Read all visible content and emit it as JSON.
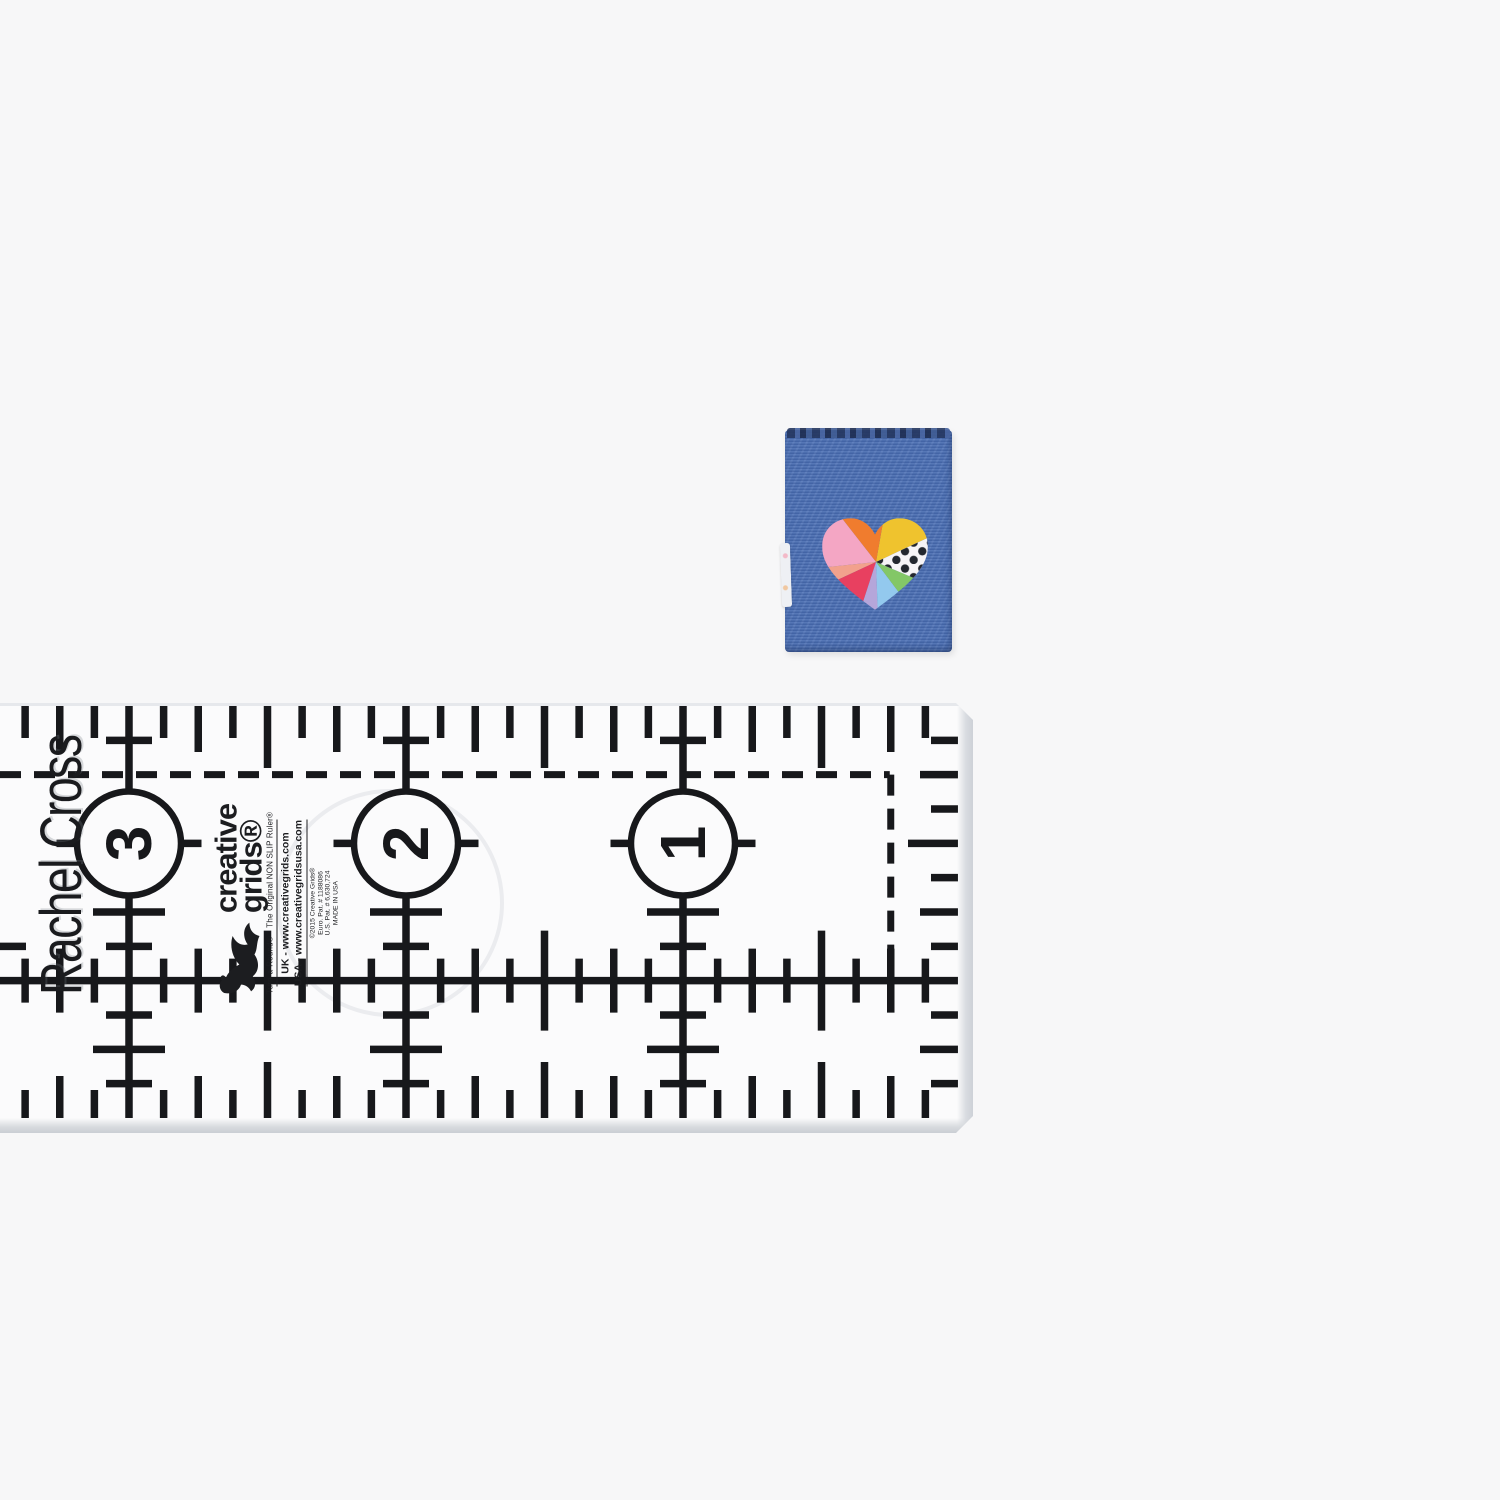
{
  "scene": {
    "background_color": "#f7f7f8"
  },
  "label": {
    "fabric_color": "#4a6fb5",
    "top_edge_color": "#24365f",
    "heart": {
      "pink": "#f4a6c4",
      "orange": "#f07c2e",
      "yellow": "#efc32e",
      "polka_bg": "#f6f4f6",
      "polka_dot": "#23272e",
      "green": "#83c767",
      "light_blue": "#93c9ee",
      "lavender": "#b5a6da",
      "red": "#e84060",
      "salmon": "#f2a18d"
    }
  },
  "ruler": {
    "owner_text": "Rachel Cross",
    "numbers": [
      "3",
      "2",
      "1"
    ],
    "ink_color": "#17181b",
    "brand": {
      "name_line1": "creative",
      "name_line2": "grids®",
      "turnaround": "Turn-a-Round®",
      "tagline": "The Original NON SLIP Ruler®",
      "uk_line": "UK - www.creativegrids.com",
      "usa_line": "USA - www.creativegridsusa.com",
      "fine_print_1": "©2015 Creative Grids®",
      "fine_print_2": "Euro. Pat. # 1188086",
      "fine_print_3": "U.S. Pat. # 6,630,724",
      "fine_print_4": "MADE IN USA"
    }
  }
}
